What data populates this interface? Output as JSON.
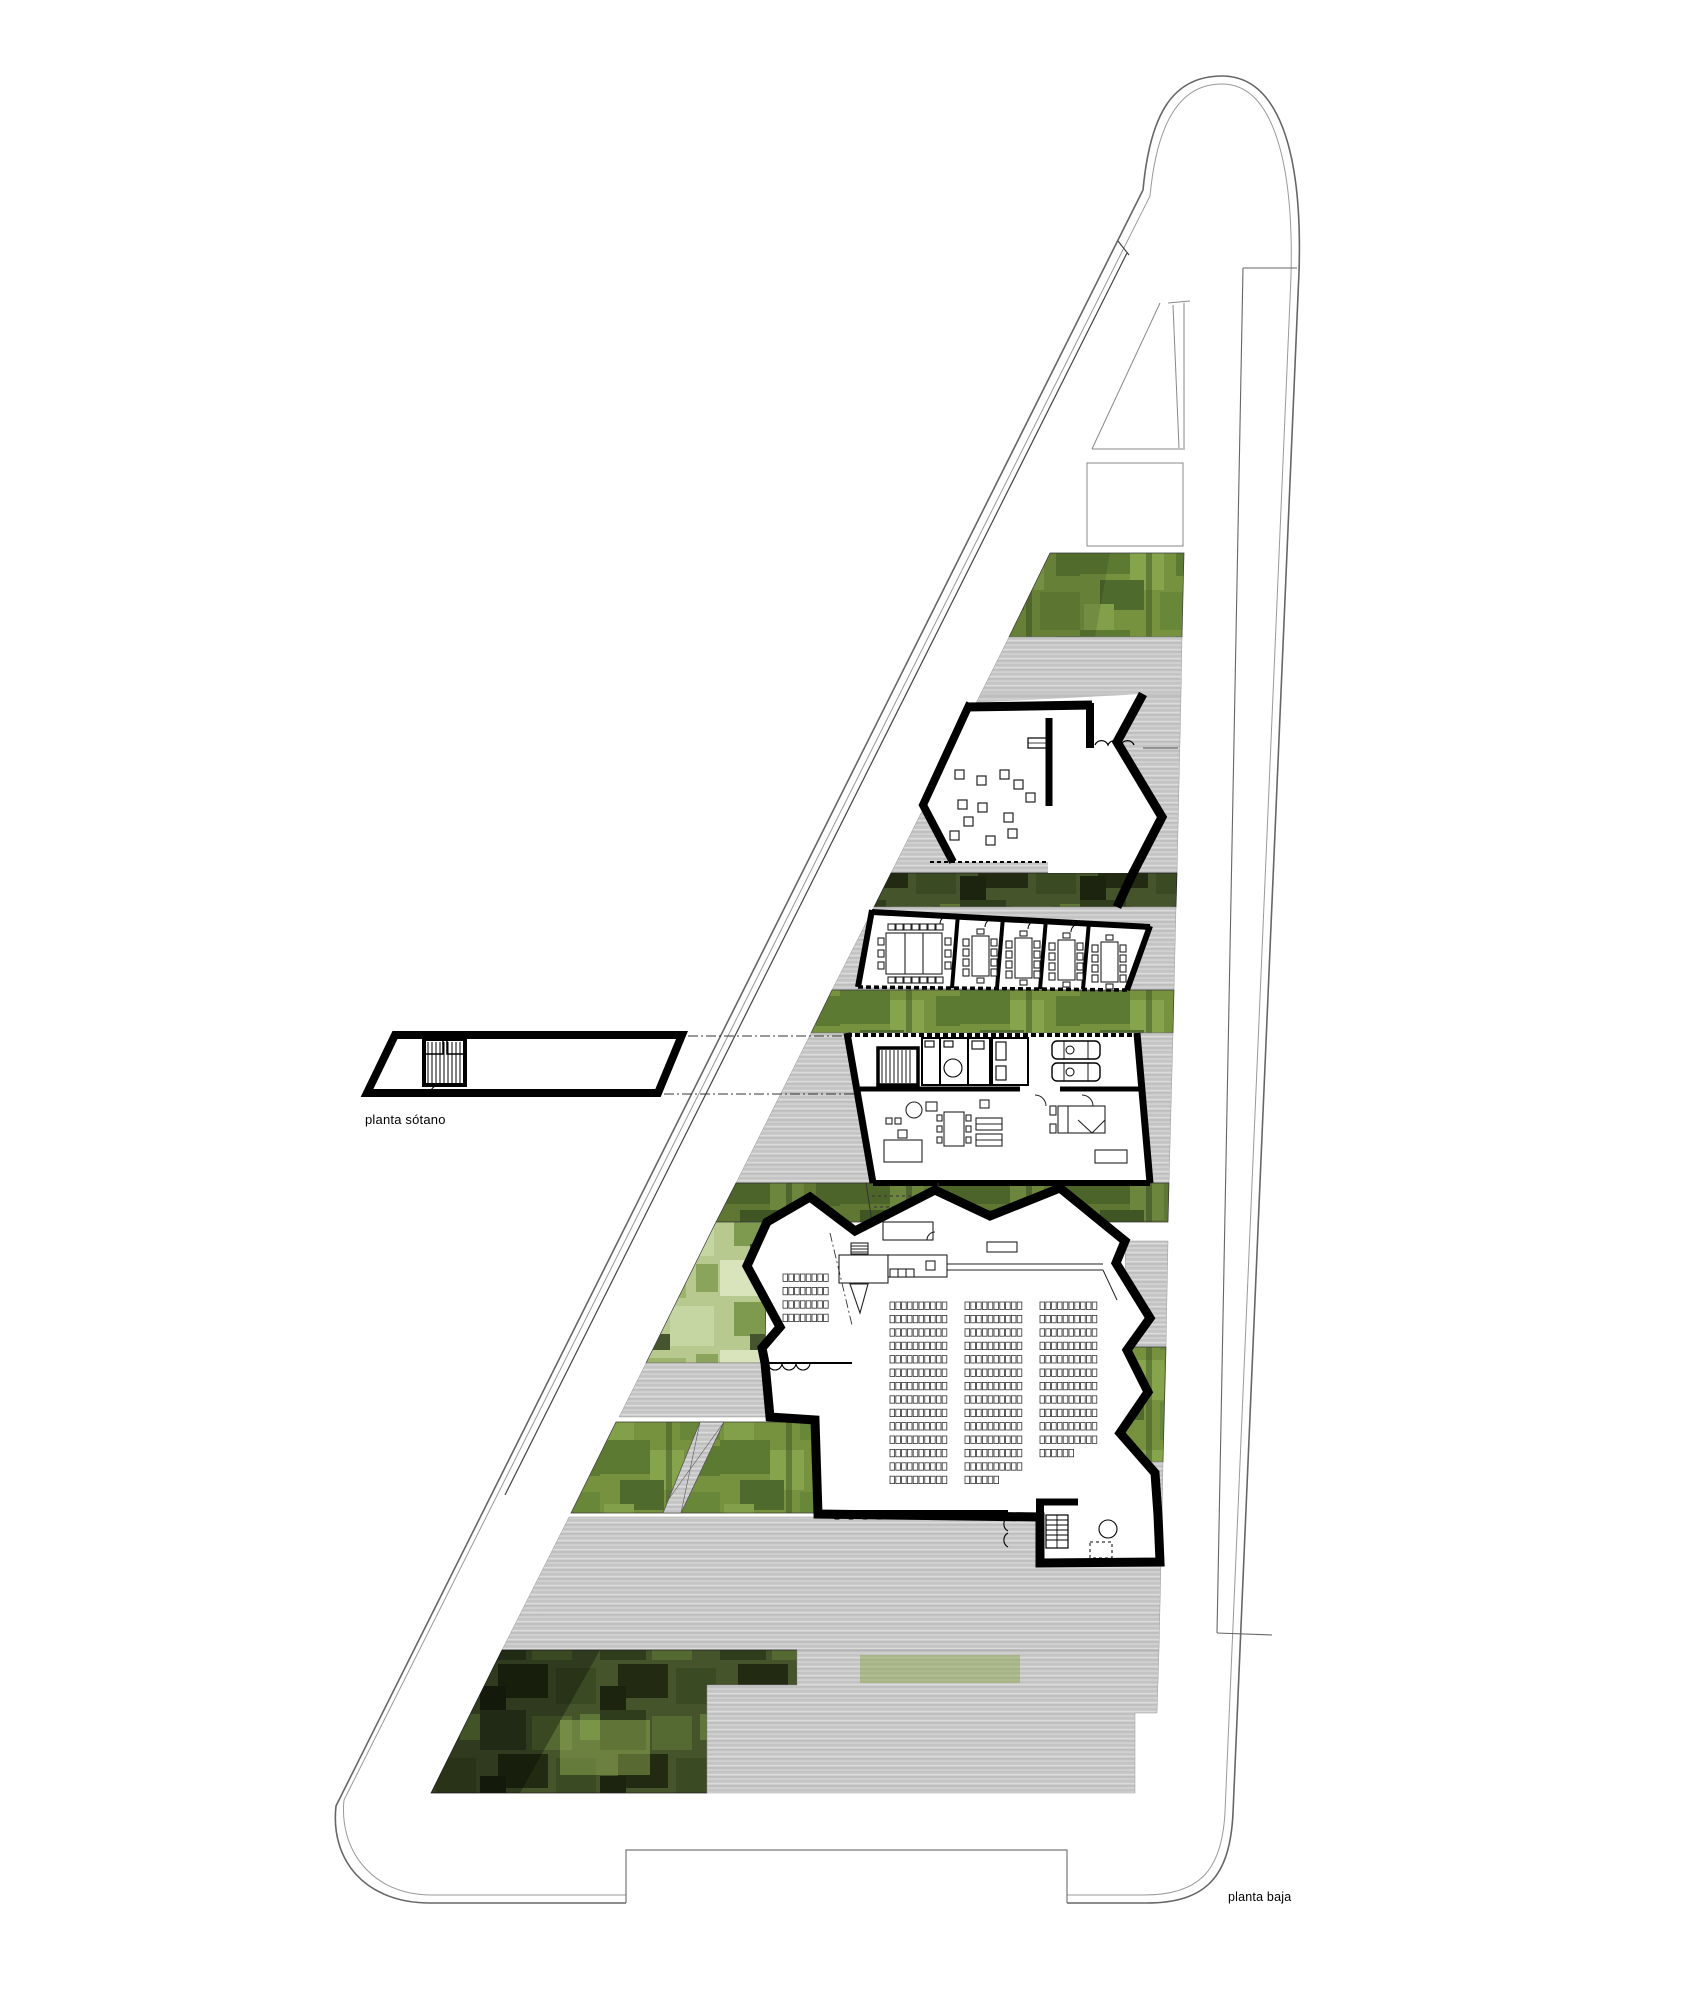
{
  "labels": {
    "basement": "planta sótano",
    "ground": "planta baja"
  },
  "colors": {
    "paving_gray": "#c9c9c9",
    "paving_gray_light": "#dcdcdc",
    "paving_gray_dark": "#b5b5b5",
    "green_mid": "#76923f",
    "green_dark": "#45542b",
    "green_deep": "#2c3618",
    "green_light": "#b7c98f",
    "wall_black": "#000000",
    "line_gray": "#777777"
  },
  "auditorium_seating": {
    "left_block": {
      "x": 783,
      "y": 1274,
      "rows": 4,
      "cols": 8
    },
    "columns": [
      {
        "x": 890,
        "y": 1302,
        "rows": 14,
        "cols": 10
      },
      {
        "x": 965,
        "y": 1302,
        "rows": 14,
        "cols": 10
      },
      {
        "x": 1040,
        "y": 1302,
        "rows": 12,
        "cols": 10
      }
    ],
    "seat_pitch_x": 5.8,
    "seat_pitch_y": 13.4,
    "seat_w": 4.6,
    "seat_h": 7.4
  },
  "garage": {
    "cars": [
      {
        "x": 1052,
        "y": 1041
      },
      {
        "x": 1052,
        "y": 1063
      }
    ]
  },
  "meeting_rooms": {
    "small_rooms": 4,
    "large_rooms": 1
  }
}
